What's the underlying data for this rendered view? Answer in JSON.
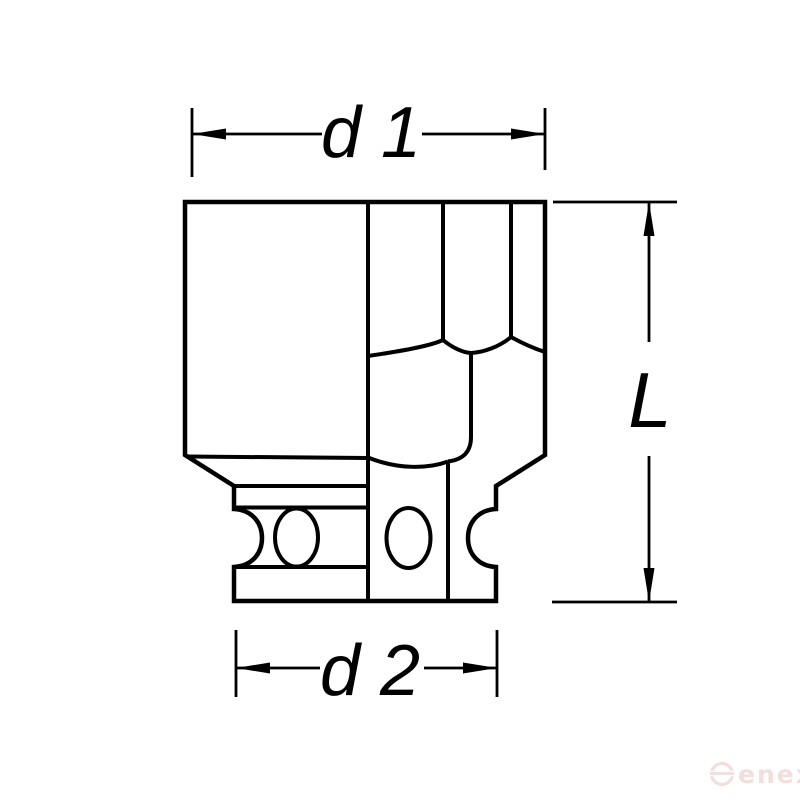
{
  "page": {
    "background_color": "#ffffff"
  },
  "drawing": {
    "line_color": "#000000",
    "dimensions": {
      "d1": {
        "label": "d 1"
      },
      "d2": {
        "label": "d 2"
      },
      "length": {
        "label": "L"
      }
    }
  },
  "watermark": {
    "brand": "enex",
    "color": "#f3dede"
  }
}
